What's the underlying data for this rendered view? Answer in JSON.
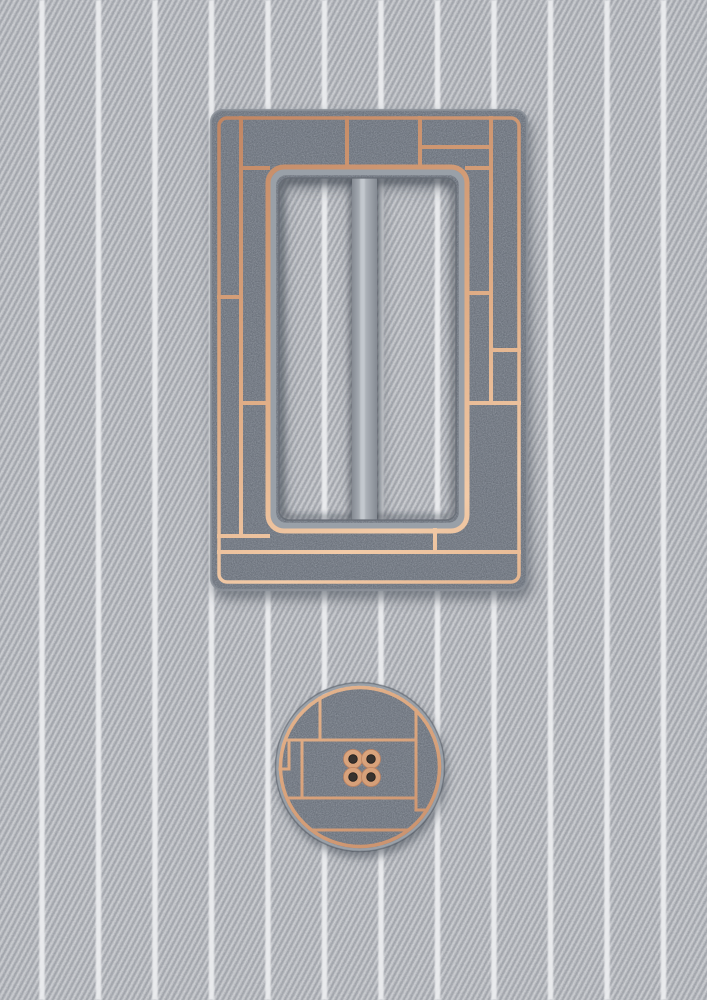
{
  "scene": {
    "description": "Flat-lay product photo: a rectangular copper-and-gray slide belt buckle with Mondrian-style inlay panels above a matching round four-hole sewing button, on light gray pinstriped twill fabric",
    "objects": [
      "rectangular slide buckle",
      "round four-hole button"
    ],
    "canvas": {
      "width": 707,
      "height": 1000
    }
  },
  "palette": {
    "fabric_base": "#b7babf",
    "fabric_rib": "#878d95",
    "pinstripe": "#eef0f2",
    "metal_gray": "#79808a",
    "metal_speck_dark": "#2e333b",
    "metal_speck_light": "#c9ced5",
    "metal_lip": "#99a0a8",
    "metal_bevel": "#8b9199",
    "metal_edge_dark": "#646a73",
    "copper_light": "#f2cba8",
    "copper_mid": "#dca77f",
    "copper_dark": "#bd8260",
    "bar_gray": "#b6bbc2",
    "bar_gray_edge": "#858b93",
    "bar_highlight": "#ccd1d6",
    "hole_dark": "#37322e",
    "shadow": "#2f3540"
  },
  "fabric": {
    "pinstripe_spacing_px": 56.5,
    "pinstripe_width_px": 5.5,
    "pinstripe_offset_px": 42,
    "pinstripe_count": 12,
    "rib_angle_deg": 28
  },
  "buckle": {
    "body": {
      "x": 211,
      "y": 110,
      "w": 316,
      "h": 480,
      "rx": 12
    },
    "border": {
      "x": 219,
      "y": 118,
      "w": 300,
      "h": 464,
      "rx": 8
    },
    "frame": {
      "x": 268,
      "y": 167,
      "w": 199,
      "h": 364,
      "rx": 16
    },
    "lip": {
      "x": 273,
      "y": 172,
      "w": 189,
      "h": 354,
      "rx": 13
    },
    "hole": {
      "x": 279,
      "y": 178,
      "w": 177,
      "h": 342,
      "rx": 10
    },
    "opening_shadow": {
      "x": 282,
      "y": 181,
      "w": 171,
      "h": 336,
      "rx": 9
    },
    "bar": {
      "x": 352,
      "y": 170,
      "w": 25,
      "h": 358,
      "rx": 9
    },
    "bar_shadow": {
      "x": 348,
      "y": 173,
      "w": 33,
      "h": 352,
      "rx": 11
    },
    "bar_highlight": {
      "x": 360,
      "y": 173,
      "w": 5,
      "h": 352,
      "rx": 2.5
    },
    "grid_lines": [
      {
        "x1": 241,
        "y1": 118,
        "x2": 241,
        "y2": 536
      },
      {
        "x1": 347,
        "y1": 118,
        "x2": 347,
        "y2": 167
      },
      {
        "x1": 420,
        "y1": 118,
        "x2": 420,
        "y2": 167
      },
      {
        "x1": 491,
        "y1": 118,
        "x2": 491,
        "y2": 403
      },
      {
        "x1": 420,
        "y1": 147,
        "x2": 491,
        "y2": 147
      },
      {
        "x1": 219,
        "y1": 297,
        "x2": 241,
        "y2": 297
      },
      {
        "x1": 241,
        "y1": 168,
        "x2": 268,
        "y2": 168
      },
      {
        "x1": 241,
        "y1": 403,
        "x2": 268,
        "y2": 403
      },
      {
        "x1": 467,
        "y1": 168,
        "x2": 491,
        "y2": 168
      },
      {
        "x1": 467,
        "y1": 293,
        "x2": 491,
        "y2": 293
      },
      {
        "x1": 491,
        "y1": 350,
        "x2": 519,
        "y2": 350
      },
      {
        "x1": 467,
        "y1": 403,
        "x2": 519,
        "y2": 403
      },
      {
        "x1": 219,
        "y1": 536,
        "x2": 268,
        "y2": 536
      },
      {
        "x1": 435,
        "y1": 530,
        "x2": 435,
        "y2": 552
      },
      {
        "x1": 219,
        "y1": 552,
        "x2": 519,
        "y2": 552
      }
    ]
  },
  "button": {
    "center_x": 360,
    "center_y": 767,
    "outline": {
      "cx": 360,
      "cy": 767,
      "r": 84.5
    },
    "bevel": {
      "cx": 360,
      "cy": 767,
      "r": 83
    },
    "rim": {
      "cx": 360,
      "cy": 767,
      "r": 79.5
    },
    "face": {
      "cx": 360,
      "cy": 767,
      "r": 78
    },
    "grid_lines": [
      {
        "x1": 320,
        "y1": 698,
        "x2": 320,
        "y2": 740
      },
      {
        "x1": 286,
        "y1": 740,
        "x2": 416,
        "y2": 740
      },
      {
        "x1": 416,
        "y1": 710,
        "x2": 416,
        "y2": 810
      },
      {
        "x1": 289,
        "y1": 740,
        "x2": 289,
        "y2": 769
      },
      {
        "x1": 280,
        "y1": 769,
        "x2": 289,
        "y2": 769
      },
      {
        "x1": 302,
        "y1": 740,
        "x2": 302,
        "y2": 798
      },
      {
        "x1": 287,
        "y1": 798,
        "x2": 416,
        "y2": 798
      },
      {
        "x1": 416,
        "y1": 810,
        "x2": 427,
        "y2": 810
      },
      {
        "x1": 313,
        "y1": 830,
        "x2": 407,
        "y2": 830
      }
    ],
    "holes": {
      "count": 4,
      "cluster_cx": 362,
      "cluster_cy": 768,
      "offsets": [
        [
          -9,
          -9
        ],
        [
          9,
          -9
        ],
        [
          -9,
          9
        ],
        [
          9,
          9
        ]
      ],
      "hole_radius": 4.3,
      "lobe_radius": 9.5
    }
  }
}
